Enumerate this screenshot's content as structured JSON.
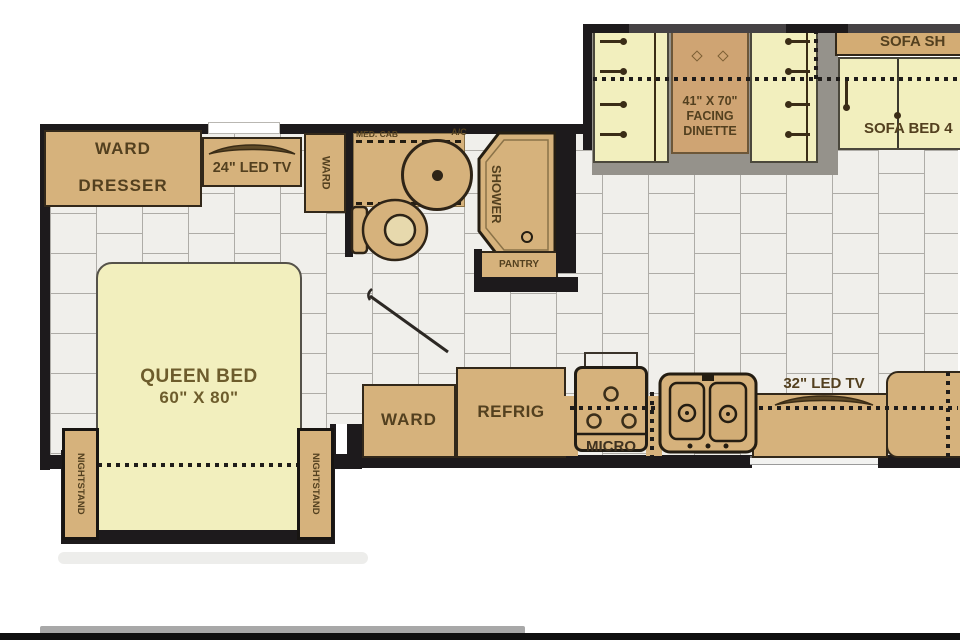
{
  "diagram": "rv-motorhome-floor-plan",
  "colors": {
    "cabinet_tan": "#d6b27c",
    "cushion_yellow": "#f2efbe",
    "table_tan": "#cfa473",
    "wall_black": "#1d1a1c",
    "floor_tile": "#f0efeb",
    "tile_grout": "#aeaca7",
    "label_brown": "#53401f"
  },
  "labels": {
    "ward_dresser_1": "WARD",
    "ward_dresser_2": "DRESSER",
    "tv24": "24\" LED TV",
    "ward_closet": "WARD",
    "med_cab": "MED. CAB",
    "ac": "A/C",
    "shower": "SHOWER",
    "pantry": "PANTRY",
    "queen_bed_1": "QUEEN BED",
    "queen_bed_2": "60\" X 80\"",
    "nightstand_left": "NIGHTSTAND",
    "nightstand_right": "NIGHTSTAND",
    "dinette_1": "41\" X 70\"",
    "dinette_2": "FACING",
    "dinette_3": "DINETTE",
    "sofa_shelf": "SOFA SH",
    "sofa_bed": "SOFA BED 4",
    "ward_kitchen": "WARD",
    "refrig": "REFRIG",
    "micro": "MICRO",
    "tv32": "32\" LED TV"
  }
}
